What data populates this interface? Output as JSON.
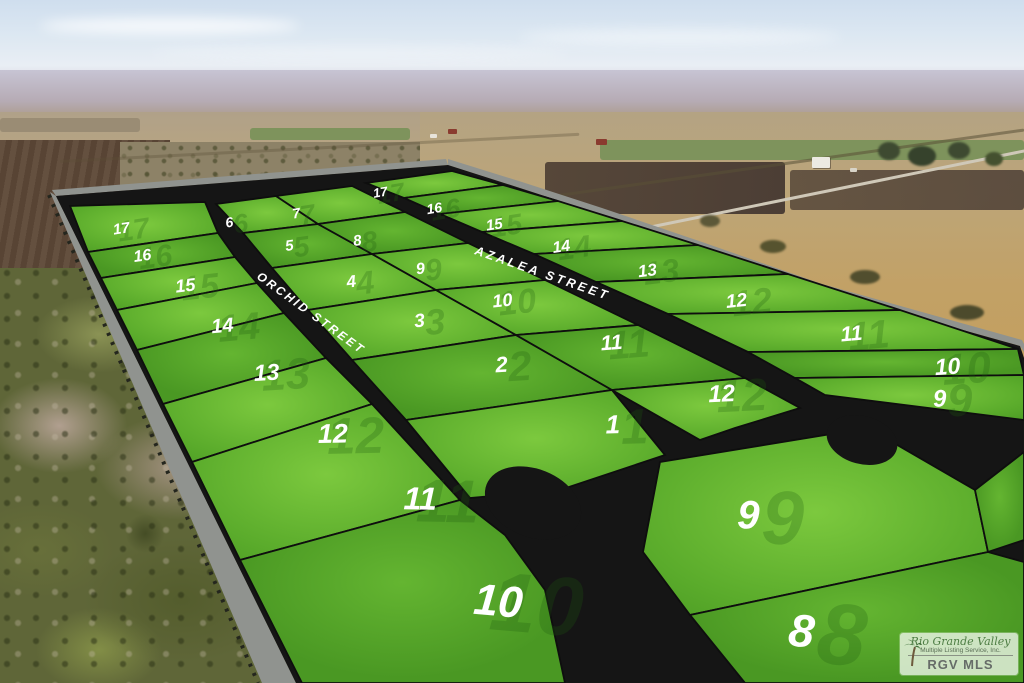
{
  "streets": {
    "orchid": "ORCHID STREET",
    "azalea": "AZALEA STREET"
  },
  "lots": {
    "west_outer": [
      "17",
      "16",
      "15",
      "14",
      "13",
      "12",
      "11",
      "10"
    ],
    "inner_west": [
      "6",
      "5",
      "4",
      "3",
      "2",
      "1"
    ],
    "inner_east": [
      "7",
      "8",
      "9",
      "10",
      "11",
      "12"
    ],
    "east_outer": [
      "17",
      "16",
      "15",
      "14",
      "13",
      "12",
      "11",
      "10",
      "9"
    ],
    "south": [
      "9",
      "8"
    ]
  },
  "watermark": {
    "line1": "Rio Grande Valley",
    "line2": "Multiple Listing Service, Inc.",
    "line3": "RGV MLS"
  },
  "colors": {
    "lot_green_light": "#7cc93e",
    "lot_green_mid": "#5aab2b",
    "lot_green_edge": "#4c9c24",
    "lot_green_dark1": "#64b531",
    "lot_green_dark2": "#4a9823",
    "road_black": "#151515",
    "perimeter_gray": "#90938f",
    "number_white": "#ffffff",
    "ghost_green": "#1e5c10"
  }
}
